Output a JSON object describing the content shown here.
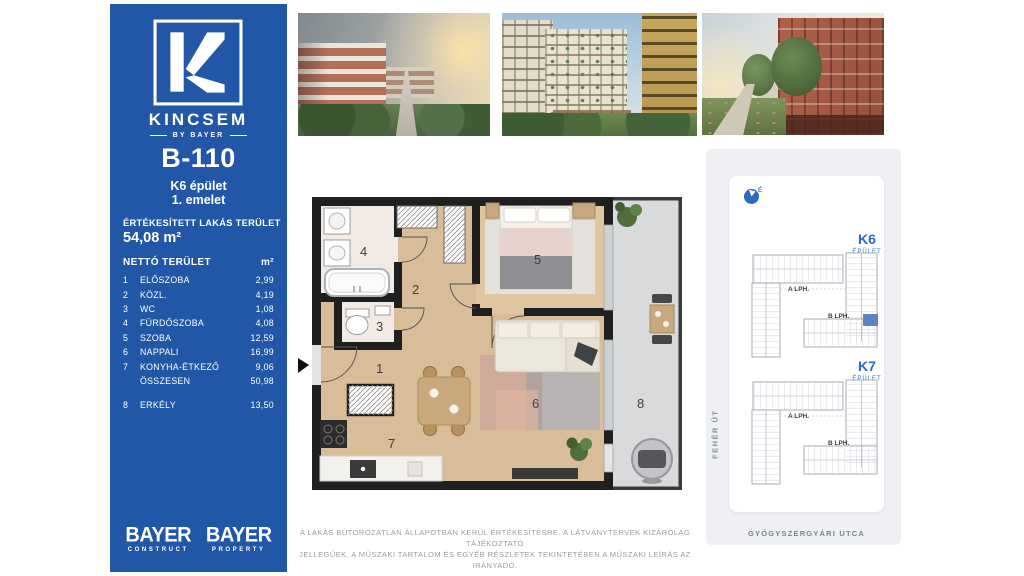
{
  "sidebar": {
    "bg_color": "#2257a8",
    "brand": "KINCSEM",
    "brand_byline": "BY BAYER",
    "unit_id": "B-110",
    "building": "K6 épület",
    "floor": "1. emelet",
    "sold_area_label": "ÉRTÉKESÍTETT LAKÁS TERÜLET",
    "sold_area_value": "54,08 m²",
    "net_area": {
      "header_label": "NETTÓ TERÜLET",
      "header_unit": "m²",
      "rows": [
        {
          "num": "1",
          "name": "ELŐSZOBA",
          "area": "2,99"
        },
        {
          "num": "2",
          "name": "KÖZL.",
          "area": "4,19"
        },
        {
          "num": "3",
          "name": "WC",
          "area": "1,08"
        },
        {
          "num": "4",
          "name": "FÜRDŐSZOBA",
          "area": "4,08"
        },
        {
          "num": "5",
          "name": "SZOBA",
          "area": "12,59"
        },
        {
          "num": "6",
          "name": "NAPPALI",
          "area": "16,99"
        },
        {
          "num": "7",
          "name": "KONYHA-ÉTKEZŐ",
          "area": "9,06"
        },
        {
          "num": "",
          "name": "ÖSSZESEN",
          "area": "50,98"
        }
      ],
      "balcony_row": {
        "num": "8",
        "name": "ERKÉLY",
        "area": "13,50"
      }
    },
    "footer_logos": [
      {
        "brand": "BAYER",
        "division": "CONSTRUCT"
      },
      {
        "brand": "BAYER",
        "division": "PROPERTY"
      }
    ]
  },
  "photos": {
    "icons": [
      "exterior-render-park",
      "exterior-render-courtyard",
      "exterior-render-street"
    ]
  },
  "floorplan": {
    "room_labels": [
      "1",
      "2",
      "3",
      "4",
      "5",
      "6",
      "7",
      "8"
    ]
  },
  "siteplan": {
    "compass_label": "É",
    "buildings": [
      {
        "name": "K6",
        "type": "ÉPÜLET",
        "lobby_a": "A LPH.",
        "lobby_b": "B LPH."
      },
      {
        "name": "K7",
        "type": "ÉPÜLET",
        "lobby_a": "A LPH.",
        "lobby_b": "B LPH."
      }
    ],
    "street_left": "FEHÉR ÚT",
    "street_bottom": "GYÓGYSZERGYÁRI UTCA",
    "highlight_color": "#5b82c6",
    "label_color": "#2a6bc0"
  },
  "disclaimer": {
    "line1": "A LAKÁS BÚTOROZATLAN ÁLLAPOTBAN KERÜL ÉRTÉKESÍTÉSRE. A LÁTVÁNYTERVEK KIZÁRÓLAG TÁJÉKOZTATÓ",
    "line2": "JELLEGŰEK. A MŰSZAKI TARTALOM ÉS EGYÉB RÉSZLETEK TEKINTETÉBEN A MŰSZAKI LEÍRÁS AZ IRÁNYADÓ."
  }
}
